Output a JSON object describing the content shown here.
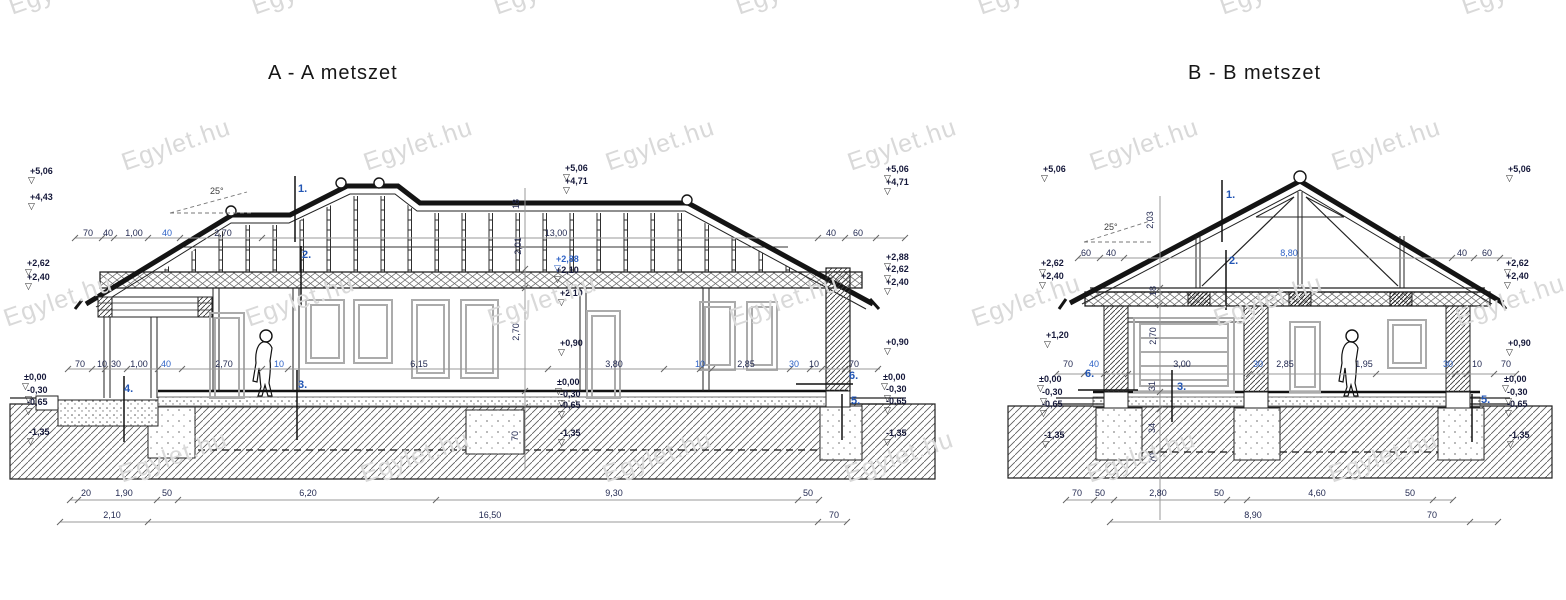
{
  "watermark": {
    "text": "Egylet.hu"
  },
  "aa": {
    "title": "A - A  metszet",
    "dims": [
      {
        "t": "70",
        "x": 88,
        "y": 228
      },
      {
        "t": "40",
        "x": 108,
        "y": 228
      },
      {
        "t": "1,00",
        "x": 134,
        "y": 228
      },
      {
        "t": "40",
        "x": 167,
        "y": 228,
        "b": 1
      },
      {
        "t": "2,70",
        "x": 223,
        "y": 228
      },
      {
        "t": "13,00",
        "x": 556,
        "y": 228
      },
      {
        "t": "40",
        "x": 831,
        "y": 228
      },
      {
        "t": "60",
        "x": 858,
        "y": 228
      },
      {
        "t": "70",
        "x": 80,
        "y": 359
      },
      {
        "t": "10",
        "x": 102,
        "y": 359
      },
      {
        "t": "30",
        "x": 116,
        "y": 359
      },
      {
        "t": "1,00",
        "x": 139,
        "y": 359
      },
      {
        "t": "40",
        "x": 166,
        "y": 359,
        "b": 1
      },
      {
        "t": "2,70",
        "x": 224,
        "y": 359
      },
      {
        "t": "10",
        "x": 279,
        "y": 359,
        "b": 1
      },
      {
        "t": "6,15",
        "x": 419,
        "y": 359
      },
      {
        "t": "3,80",
        "x": 614,
        "y": 359
      },
      {
        "t": "10",
        "x": 700,
        "y": 359,
        "b": 1
      },
      {
        "t": "2,85",
        "x": 746,
        "y": 359
      },
      {
        "t": "30",
        "x": 794,
        "y": 359,
        "b": 1
      },
      {
        "t": "10",
        "x": 814,
        "y": 359
      },
      {
        "t": "70",
        "x": 854,
        "y": 359
      },
      {
        "t": "20",
        "x": 86,
        "y": 488
      },
      {
        "t": "1,90",
        "x": 124,
        "y": 488
      },
      {
        "t": "50",
        "x": 167,
        "y": 488
      },
      {
        "t": "6,20",
        "x": 308,
        "y": 488
      },
      {
        "t": "9,30",
        "x": 614,
        "y": 488
      },
      {
        "t": "50",
        "x": 808,
        "y": 488
      },
      {
        "t": "2,10",
        "x": 112,
        "y": 510
      },
      {
        "t": "16,50",
        "x": 490,
        "y": 510
      },
      {
        "t": "70",
        "x": 834,
        "y": 510
      }
    ],
    "elevations": [
      {
        "t": "+5,06",
        "x": 30,
        "y": 166
      },
      {
        "t": "+4,43",
        "x": 30,
        "y": 192
      },
      {
        "t": "+2,62",
        "x": 27,
        "y": 258
      },
      {
        "t": "+2,40",
        "x": 27,
        "y": 272
      },
      {
        "t": "±0,00",
        "x": 24,
        "y": 372
      },
      {
        "t": "-0,30",
        "x": 27,
        "y": 385
      },
      {
        "t": "-0,65",
        "x": 27,
        "y": 397
      },
      {
        "t": "-1,35",
        "x": 29,
        "y": 427
      },
      {
        "t": "+5,06",
        "x": 565,
        "y": 163
      },
      {
        "t": "+4,71",
        "x": 565,
        "y": 176
      },
      {
        "t": "+2,88",
        "x": 556,
        "y": 254,
        "b": 1
      },
      {
        "t": "+2,10",
        "x": 556,
        "y": 265
      },
      {
        "t": "+2,10",
        "x": 560,
        "y": 288
      },
      {
        "t": "+0,90",
        "x": 560,
        "y": 338
      },
      {
        "t": "±0,00",
        "x": 557,
        "y": 377
      },
      {
        "t": "-0,30",
        "x": 560,
        "y": 389
      },
      {
        "t": "-0,65",
        "x": 560,
        "y": 400
      },
      {
        "t": "-1,35",
        "x": 560,
        "y": 428
      },
      {
        "t": "+5,06",
        "x": 886,
        "y": 164
      },
      {
        "t": "+4,71",
        "x": 886,
        "y": 177
      },
      {
        "t": "+2,88",
        "x": 886,
        "y": 252
      },
      {
        "t": "+2,62",
        "x": 886,
        "y": 264
      },
      {
        "t": "+2,40",
        "x": 886,
        "y": 277
      },
      {
        "t": "+0,90",
        "x": 886,
        "y": 337
      },
      {
        "t": "±0,00",
        "x": 883,
        "y": 372
      },
      {
        "t": "-0,30",
        "x": 886,
        "y": 384
      },
      {
        "t": "-0,65",
        "x": 886,
        "y": 396
      },
      {
        "t": "-1,35",
        "x": 886,
        "y": 428
      }
    ],
    "vdims": [
      {
        "t": "18",
        "x": 516,
        "y": 204
      },
      {
        "t": "2,01",
        "x": 518,
        "y": 246
      },
      {
        "t": "2,70",
        "x": 516,
        "y": 332
      },
      {
        "t": "70",
        "x": 515,
        "y": 436
      }
    ],
    "callouts": [
      {
        "t": "1.",
        "x": 298,
        "y": 184
      },
      {
        "t": "2.",
        "x": 302,
        "y": 250
      },
      {
        "t": "3.",
        "x": 298,
        "y": 380
      },
      {
        "t": "4.",
        "x": 124,
        "y": 384
      },
      {
        "t": "6.",
        "x": 849,
        "y": 371
      },
      {
        "t": "5.",
        "x": 851,
        "y": 396
      }
    ],
    "notes": [
      {
        "t": "25°",
        "x": 210,
        "y": 186
      }
    ]
  },
  "bb": {
    "title": "B - B  metszet",
    "dims": [
      {
        "t": "60",
        "x": 1086,
        "y": 248
      },
      {
        "t": "40",
        "x": 1111,
        "y": 248
      },
      {
        "t": "8,80",
        "x": 1289,
        "y": 248,
        "b": 1
      },
      {
        "t": "40",
        "x": 1462,
        "y": 248
      },
      {
        "t": "60",
        "x": 1487,
        "y": 248
      },
      {
        "t": "70",
        "x": 1068,
        "y": 359
      },
      {
        "t": "40",
        "x": 1094,
        "y": 359,
        "b": 1
      },
      {
        "t": "3,00",
        "x": 1182,
        "y": 359
      },
      {
        "t": "30",
        "x": 1258,
        "y": 359,
        "b": 1
      },
      {
        "t": "2,85",
        "x": 1285,
        "y": 359
      },
      {
        "t": "1,95",
        "x": 1364,
        "y": 359
      },
      {
        "t": "30",
        "x": 1448,
        "y": 359,
        "b": 1
      },
      {
        "t": "10",
        "x": 1477,
        "y": 359
      },
      {
        "t": "70",
        "x": 1506,
        "y": 359
      },
      {
        "t": "70",
        "x": 1077,
        "y": 488
      },
      {
        "t": "50",
        "x": 1100,
        "y": 488
      },
      {
        "t": "2,80",
        "x": 1158,
        "y": 488
      },
      {
        "t": "50",
        "x": 1219,
        "y": 488
      },
      {
        "t": "4,60",
        "x": 1317,
        "y": 488
      },
      {
        "t": "50",
        "x": 1410,
        "y": 488
      },
      {
        "t": "8,90",
        "x": 1253,
        "y": 510
      },
      {
        "t": "70",
        "x": 1432,
        "y": 510
      }
    ],
    "elevations": [
      {
        "t": "+5,06",
        "x": 1043,
        "y": 164
      },
      {
        "t": "+2,62",
        "x": 1041,
        "y": 258
      },
      {
        "t": "+2,40",
        "x": 1041,
        "y": 271
      },
      {
        "t": "+1,20",
        "x": 1046,
        "y": 330
      },
      {
        "t": "±0,00",
        "x": 1039,
        "y": 374
      },
      {
        "t": "-0,30",
        "x": 1042,
        "y": 387
      },
      {
        "t": "-0,65",
        "x": 1042,
        "y": 399
      },
      {
        "t": "-1,35",
        "x": 1044,
        "y": 430
      },
      {
        "t": "+5,06",
        "x": 1508,
        "y": 164
      },
      {
        "t": "+2,62",
        "x": 1506,
        "y": 258
      },
      {
        "t": "+2,40",
        "x": 1506,
        "y": 271
      },
      {
        "t": "+0,90",
        "x": 1508,
        "y": 338
      },
      {
        "t": "±0,00",
        "x": 1504,
        "y": 374
      },
      {
        "t": "-0,30",
        "x": 1507,
        "y": 387
      },
      {
        "t": "-0,65",
        "x": 1507,
        "y": 399
      },
      {
        "t": "-1,35",
        "x": 1509,
        "y": 430
      }
    ],
    "vdims": [
      {
        "t": "2,03",
        "x": 1150,
        "y": 220
      },
      {
        "t": "18",
        "x": 1153,
        "y": 291
      },
      {
        "t": "2,70",
        "x": 1153,
        "y": 336
      },
      {
        "t": "31",
        "x": 1152,
        "y": 386
      },
      {
        "t": "34",
        "x": 1152,
        "y": 428
      },
      {
        "t": "70",
        "x": 1153,
        "y": 458
      }
    ],
    "callouts": [
      {
        "t": "1.",
        "x": 1226,
        "y": 190
      },
      {
        "t": "2.",
        "x": 1229,
        "y": 256
      },
      {
        "t": "3.",
        "x": 1177,
        "y": 382
      },
      {
        "t": "6.",
        "x": 1085,
        "y": 369
      },
      {
        "t": "5.",
        "x": 1481,
        "y": 395
      }
    ],
    "notes": [
      {
        "t": "25°",
        "x": 1104,
        "y": 222
      }
    ]
  }
}
